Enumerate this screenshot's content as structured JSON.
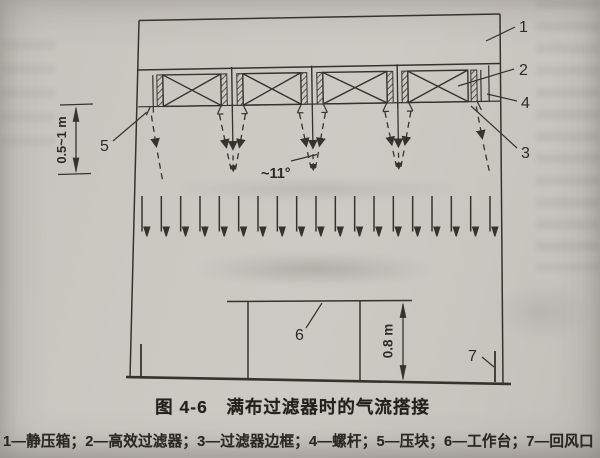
{
  "figure": {
    "caption": "图 4-6　满布过滤器时的气流搭接",
    "legend": "1—静压箱；2—高效过滤器；3—过滤器边框；4—螺杆；5—压块；6—工作台；7—回风口",
    "legend_items": [
      {
        "num": "1",
        "name": "静压箱"
      },
      {
        "num": "2",
        "name": "高效过滤器"
      },
      {
        "num": "3",
        "name": "过滤器边框"
      },
      {
        "num": "4",
        "name": "螺杆"
      },
      {
        "num": "5",
        "name": "压块"
      },
      {
        "num": "6",
        "name": "工作台"
      },
      {
        "num": "7",
        "name": "回风口"
      }
    ],
    "callouts": {
      "n1": "1",
      "n2": "2",
      "n3": "3",
      "n4": "4",
      "n5": "5",
      "n6": "6",
      "n7": "7"
    },
    "annotations": {
      "jet_angle": "~11°",
      "filter_distance": "0.5~1 m",
      "table_height": "0.8 m"
    },
    "diagram": {
      "filter_count": 4,
      "airflow_arrow_count": 19,
      "jet_count": 5
    },
    "colors": {
      "ink": "#36332d",
      "paper": "#cbc8c2"
    }
  }
}
